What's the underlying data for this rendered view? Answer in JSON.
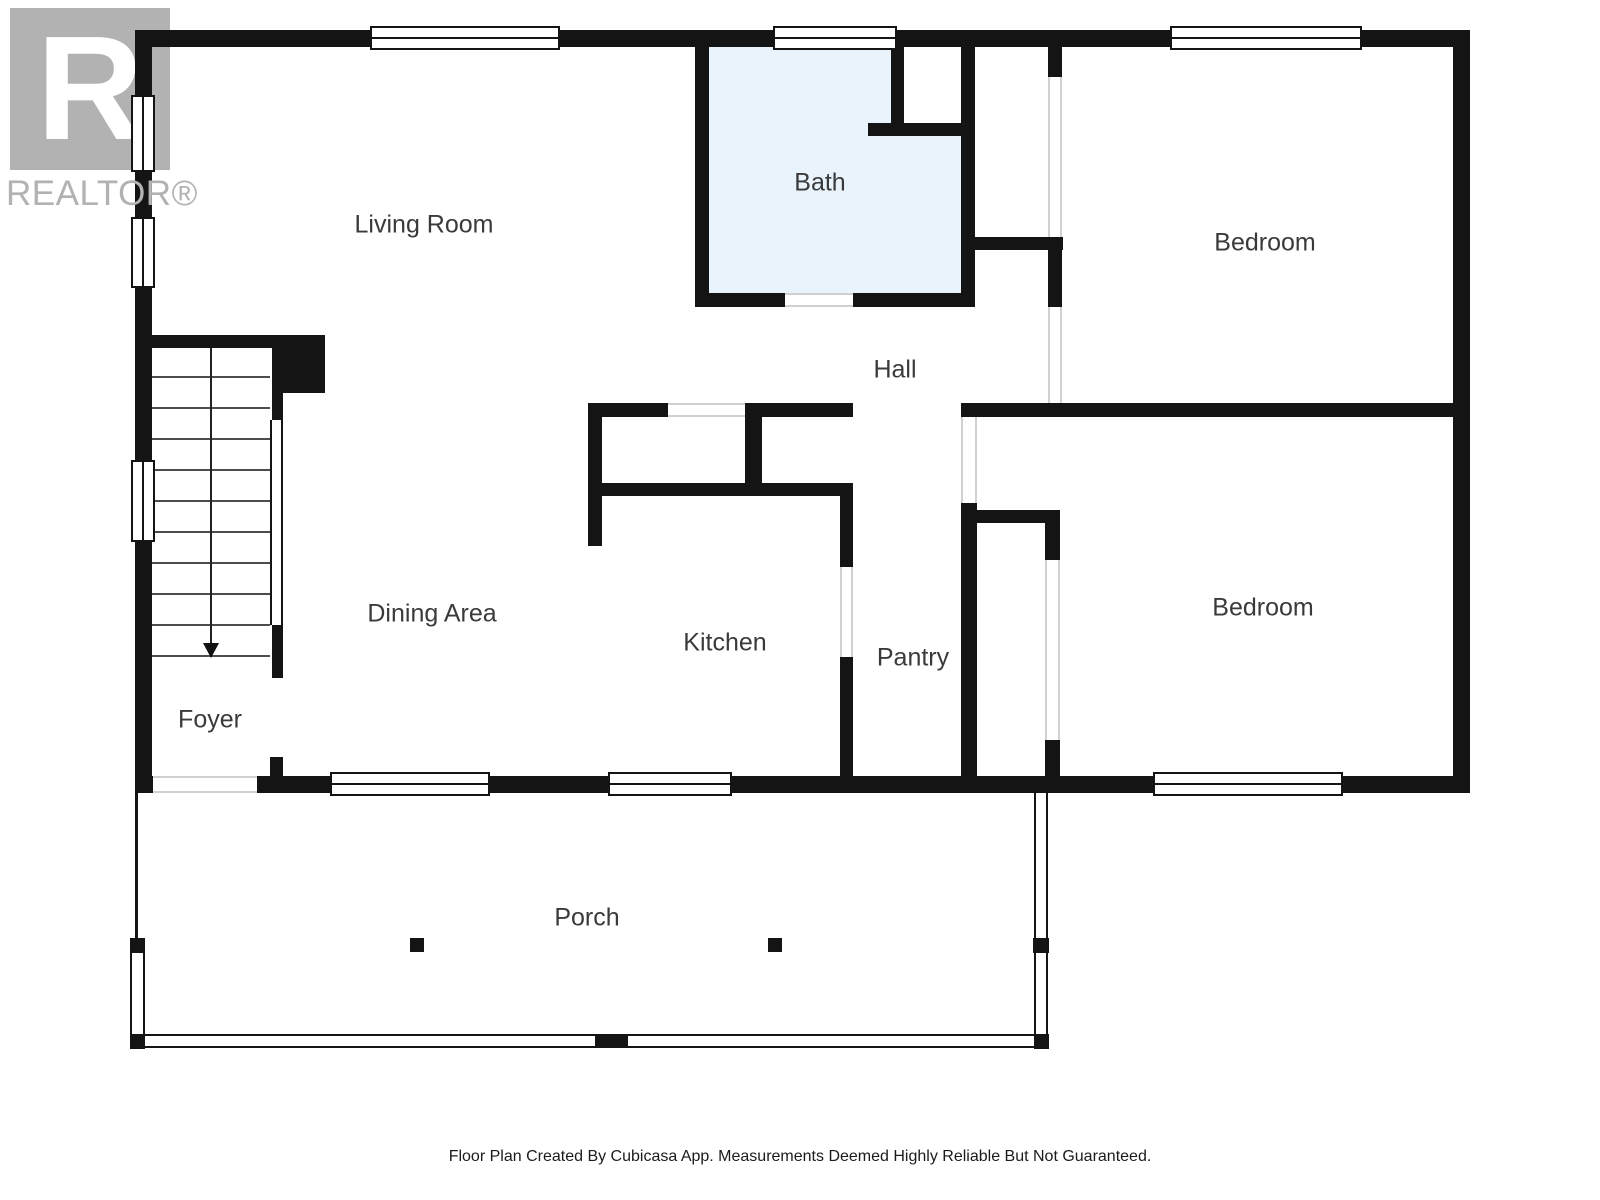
{
  "logo": {
    "letter": "R",
    "brand": "REALTOR®"
  },
  "footer": {
    "disclaimer": "Floor Plan Created By Cubicasa App. Measurements Deemed Highly Reliable But Not Guaranteed."
  },
  "colors": {
    "wall": "#141414",
    "bath_fill": "#e8f3fc",
    "logo_gray": "#b2b2b2",
    "label_text": "#3a3a3a",
    "opening_line": "#d0d0d0"
  },
  "rooms": [
    {
      "id": "living-room",
      "label": "Living Room",
      "cx": 424,
      "cy": 225
    },
    {
      "id": "bath",
      "label": "Bath",
      "cx": 820,
      "cy": 183
    },
    {
      "id": "bedroom-top",
      "label": "Bedroom",
      "cx": 1265,
      "cy": 243
    },
    {
      "id": "hall",
      "label": "Hall",
      "cx": 895,
      "cy": 370
    },
    {
      "id": "dining-area",
      "label": "Dining Area",
      "cx": 432,
      "cy": 614
    },
    {
      "id": "kitchen",
      "label": "Kitchen",
      "cx": 725,
      "cy": 643
    },
    {
      "id": "pantry",
      "label": "Pantry",
      "cx": 913,
      "cy": 658
    },
    {
      "id": "bedroom-bottom",
      "label": "Bedroom",
      "cx": 1263,
      "cy": 608
    },
    {
      "id": "foyer",
      "label": "Foyer",
      "cx": 210,
      "cy": 720
    },
    {
      "id": "porch",
      "label": "Porch",
      "cx": 587,
      "cy": 918
    }
  ],
  "geometry": {
    "plan_size": {
      "w": 1600,
      "h": 1200
    },
    "fills": [
      [
        "bath-floor",
        709,
        47,
        252,
        246,
        "#e8f3fc"
      ],
      [
        "bath-notch-white",
        904,
        47,
        57,
        76,
        "#ffffff"
      ]
    ],
    "walls": [
      [
        "ext-top",
        135,
        30,
        1335,
        17
      ],
      [
        "ext-left",
        135,
        30,
        17,
        763
      ],
      [
        "ext-right",
        1453,
        30,
        17,
        763
      ],
      [
        "ext-bottom",
        135,
        776,
        1335,
        17
      ],
      [
        "bath-west",
        695,
        47,
        14,
        246
      ],
      [
        "bath-south-left",
        695,
        293,
        90,
        14
      ],
      [
        "bath-south-right",
        853,
        293,
        122,
        14
      ],
      [
        "bath-east",
        961,
        47,
        14,
        260
      ],
      [
        "bath-notch-vert",
        891,
        47,
        13,
        76
      ],
      [
        "bath-notch-horiz",
        868,
        123,
        107,
        13
      ],
      [
        "closet-jamb-top",
        1048,
        47,
        14,
        30
      ],
      [
        "closet-shelf",
        975,
        237,
        88,
        13
      ],
      [
        "closet-east",
        1048,
        237,
        14,
        70
      ],
      [
        "hall-north-a",
        588,
        403,
        80,
        14
      ],
      [
        "hall-north-b",
        745,
        403,
        108,
        14
      ],
      [
        "bedrooms-divider",
        961,
        403,
        509,
        14
      ],
      [
        "kitchen-entry-jamb",
        745,
        403,
        17,
        80
      ],
      [
        "kitchen-north",
        588,
        483,
        265,
        13
      ],
      [
        "kitchen-west",
        588,
        403,
        14,
        143
      ],
      [
        "pantry-west-upper",
        840,
        483,
        13,
        84
      ],
      [
        "pantry-west-lower",
        840,
        657,
        13,
        119
      ],
      [
        "pantry-east",
        961,
        503,
        16,
        273
      ],
      [
        "bedroom-closet-north",
        975,
        510,
        85,
        13
      ],
      [
        "bedroom-closet-east-upper",
        1045,
        510,
        15,
        50
      ],
      [
        "bedroom-closet-east-lower",
        1045,
        740,
        15,
        36
      ],
      [
        "stair-head-wall",
        152,
        335,
        120,
        13
      ],
      [
        "stair-corner-block",
        272,
        335,
        53,
        58
      ],
      [
        "stair-side-upper",
        272,
        393,
        11,
        27
      ],
      [
        "stair-side-lower",
        272,
        625,
        11,
        53
      ],
      [
        "foyer-jamb",
        270,
        757,
        13,
        19
      ]
    ],
    "windows": [
      [
        "window-living-top",
        370,
        26,
        190,
        24,
        "h"
      ],
      [
        "window-bath-top",
        773,
        26,
        124,
        24,
        "h"
      ],
      [
        "window-bedroom-top",
        1170,
        26,
        192,
        24,
        "h"
      ],
      [
        "window-left-upper",
        131,
        95,
        24,
        77,
        "v"
      ],
      [
        "window-left-mid",
        131,
        217,
        24,
        71,
        "v"
      ],
      [
        "window-left-stairs",
        131,
        460,
        24,
        82,
        "v"
      ],
      [
        "window-dining-bottom",
        330,
        772,
        160,
        24,
        "h"
      ],
      [
        "window-kitchen-bottom",
        608,
        772,
        124,
        24,
        "h"
      ],
      [
        "window-bedroom-bottom",
        1153,
        772,
        190,
        24,
        "h"
      ]
    ],
    "openings": [
      [
        "opening-bath-door",
        785,
        293,
        68,
        14,
        "h"
      ],
      [
        "opening-closet-top-bedroom",
        1048,
        77,
        14,
        160,
        "v"
      ],
      [
        "opening-closet-hall",
        1048,
        307,
        14,
        96,
        "v"
      ],
      [
        "opening-hall-living",
        668,
        403,
        77,
        14,
        "h"
      ],
      [
        "opening-bedroom-bottom-door",
        961,
        417,
        16,
        86,
        "v"
      ],
      [
        "opening-pantry-kitchen",
        840,
        567,
        13,
        90,
        "v"
      ],
      [
        "opening-bedroom-closet-door",
        1045,
        560,
        15,
        180,
        "v"
      ],
      [
        "opening-front-entry",
        153,
        776,
        104,
        17,
        "h"
      ]
    ],
    "stairs": {
      "x": 152,
      "w": 118,
      "top": 345,
      "bottom": 655,
      "steps": 10,
      "center_x": 210,
      "arrow_y": 643,
      "railing": [
        270,
        420,
        13,
        205
      ]
    },
    "porch": {
      "left_line": [
        135,
        793,
        3,
        147
      ],
      "rails": [
        [
          "porch-rail-left",
          130,
          952,
          15,
          84,
          "v"
        ],
        [
          "porch-rail-right-top",
          1034,
          793,
          14,
          145,
          "v"
        ],
        [
          "porch-rail-right-bottom",
          1034,
          952,
          14,
          84,
          "v"
        ],
        [
          "porch-rail-bottom",
          135,
          1034,
          913,
          14,
          "h"
        ]
      ],
      "posts": [
        [
          "porch-post-left-mid",
          130,
          938,
          15,
          15
        ],
        [
          "porch-post-left-bottom",
          130,
          1034,
          15,
          15
        ],
        [
          "porch-post-right-mid",
          1033,
          938,
          16,
          15
        ],
        [
          "porch-post-right-bottom",
          1034,
          1034,
          15,
          15
        ],
        [
          "porch-column-left",
          410,
          938,
          14,
          14
        ],
        [
          "porch-column-right",
          768,
          938,
          14,
          14
        ],
        [
          "porch-step-block",
          595,
          1034,
          33,
          14
        ]
      ]
    }
  }
}
